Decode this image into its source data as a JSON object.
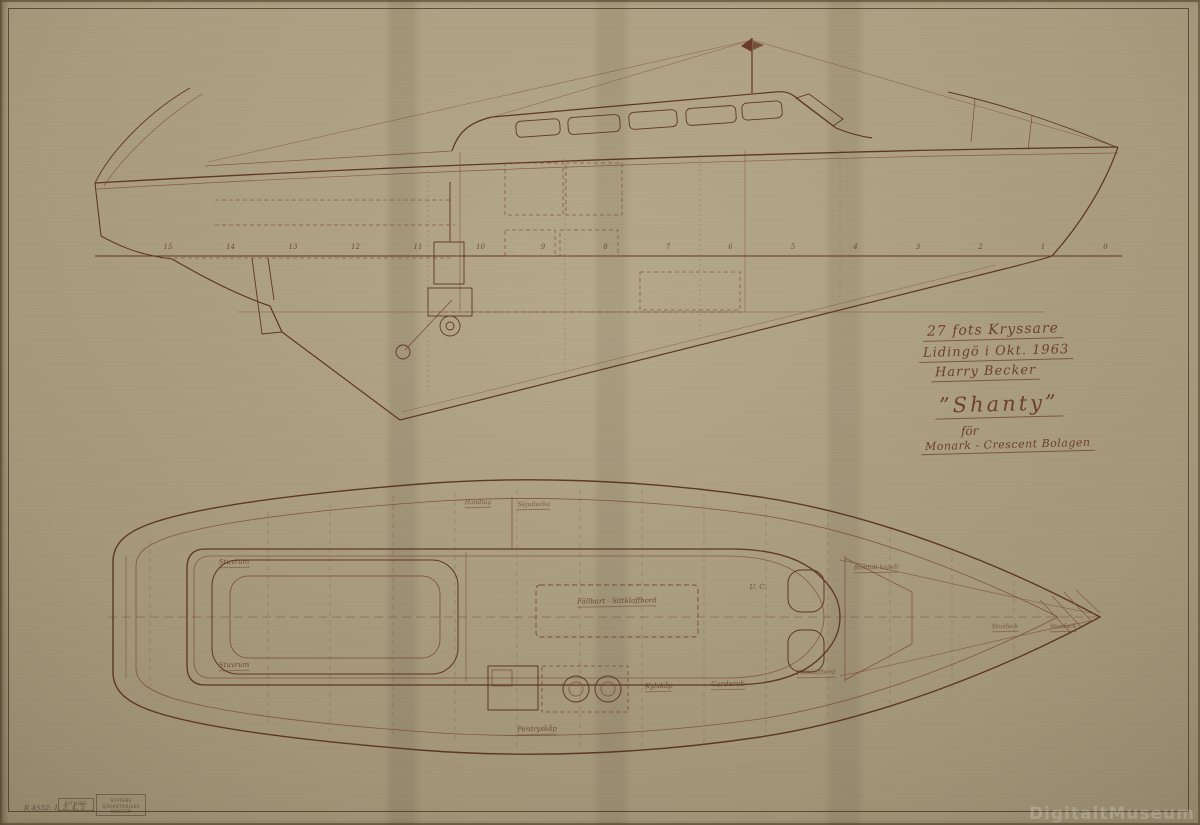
{
  "document": {
    "kind": "scanned boat construction drawing",
    "views": [
      "profile (side) view",
      "deck / interior plan view"
    ]
  },
  "title_block": {
    "type_line": "27 fots Kryssare",
    "place_date_line": "Lidingö i Okt. 1963",
    "designer_signature": "Harry Becker",
    "boat_name": "”Shanty”",
    "preposition": "för",
    "client_line": "Monark - Crescent Bolagen"
  },
  "profile_view": {
    "stations": [
      "15",
      "14",
      "13",
      "12",
      "11",
      "10",
      "9",
      "8",
      "7",
      "6",
      "5",
      "4",
      "3",
      "2",
      "1",
      "0"
    ]
  },
  "plan_view": {
    "labels": [
      {
        "text": "Handtag"
      },
      {
        "text": "Skjutlucka"
      },
      {
        "text": "Stuvrum"
      },
      {
        "text": "Stuvrum"
      },
      {
        "text": "Fällbart - Sittklaffbord"
      },
      {
        "text": "U. C."
      },
      {
        "text": "Bomtält kapell"
      },
      {
        "text": "Kylskåp"
      },
      {
        "text": "Garderob"
      },
      {
        "text": "Fällklaffbord"
      },
      {
        "text": "Pentryskåp"
      },
      {
        "text": "Stuvfack"
      },
      {
        "text": "Stuvfack"
      }
    ]
  },
  "stamp": {
    "left_box": "RITNING",
    "museum_line1": "STATENS",
    "museum_line2": "SJÖHISTORISKA",
    "museum_line3": "MUSEUM",
    "handwritten": "R 4532: 1, 3, 4, 5"
  },
  "watermark": "DigitaltMuseum",
  "colors": {
    "paper": "#b5a788",
    "ink": "#5e3526",
    "ink_light": "#7a4a35",
    "handwriting": "#6d3f2b"
  }
}
